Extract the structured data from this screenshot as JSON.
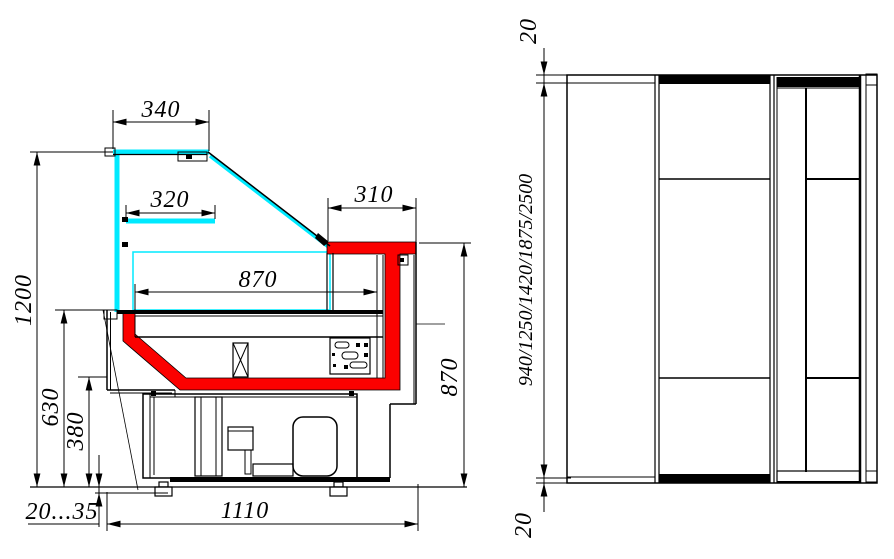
{
  "drawing": {
    "type": "technical dimensional drawing",
    "subject": "refrigerated display counter (cross-section and plan view)",
    "colors": {
      "line": "#000000",
      "glass": "#00eaff",
      "insulation": "#fb0100",
      "background": "#ffffff"
    },
    "section": {
      "dim_top_shelf_width": "340",
      "dim_mid_shelf_width": "320",
      "dim_worktop_depth": "310",
      "dim_display_bed_width": "870",
      "dim_total_height": "1200",
      "dim_front_panel_height": "630",
      "dim_base_height": "380",
      "dim_foot_adjust": "20...35",
      "dim_base_depth": "1110",
      "dim_worktop_height": "870"
    },
    "plan": {
      "dim_end_overhang_top": "20",
      "dim_case_lengths": "940/1250/1420/1875/2500",
      "dim_end_overhang_bottom": "20"
    }
  }
}
